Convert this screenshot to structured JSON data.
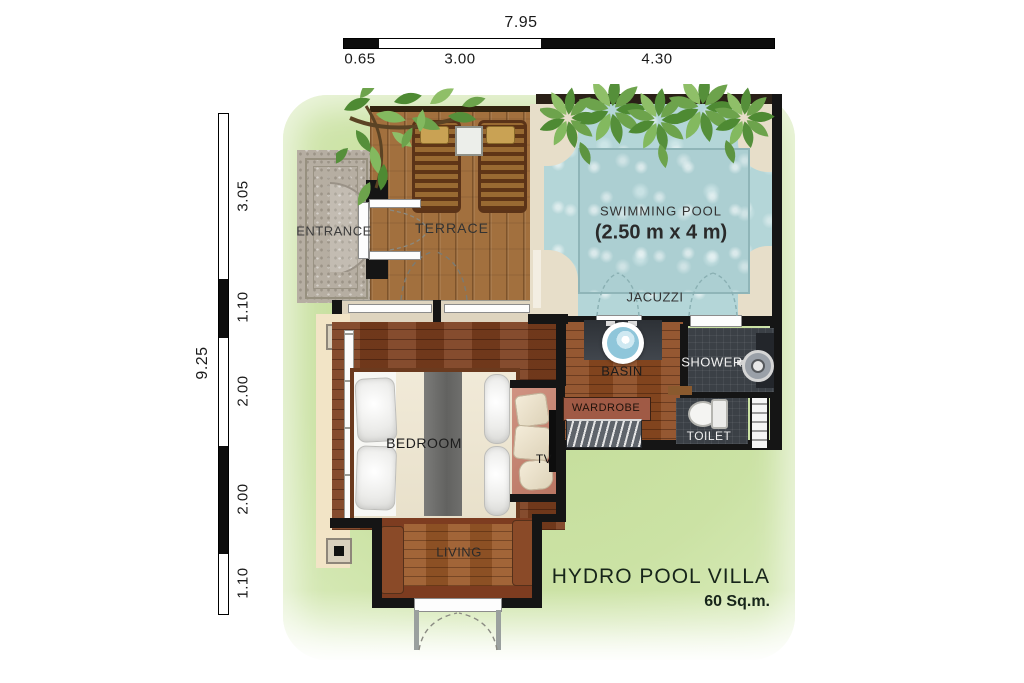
{
  "title": {
    "name": "HYDRO POOL VILLA",
    "area": "60 Sq.m."
  },
  "dimensions": {
    "top": {
      "total": "7.95",
      "segments": [
        {
          "label": "0.65"
        },
        {
          "label": "3.00"
        },
        {
          "label": "4.30"
        }
      ]
    },
    "left": {
      "total": "9.25",
      "segments": [
        {
          "label": "3.05"
        },
        {
          "label": "1.10"
        },
        {
          "label": "2.00"
        },
        {
          "label": "2.00"
        },
        {
          "label": "1.10"
        }
      ]
    }
  },
  "rooms": {
    "entrance": {
      "label": "ENTRANCE"
    },
    "terrace": {
      "label": "TERRACE"
    },
    "pool": {
      "label": "SWIMMING POOL",
      "size": "(2.50 m x 4 m)"
    },
    "jacuzzi": {
      "label": "JACUZZI"
    },
    "basin": {
      "label": "BASIN"
    },
    "shower": {
      "label": "SHOWER"
    },
    "wardrobe": {
      "label": "WARDROBE"
    },
    "toilet": {
      "label": "TOILET"
    },
    "bedroom": {
      "label": "BEDROOM"
    },
    "tv": {
      "label": "TV"
    },
    "living": {
      "label": "LIVING"
    }
  },
  "icons": {
    "foliage": "foliage-icon",
    "basin": "basin-icon",
    "shower_head": "shower-head-icon",
    "toilet_fixture": "toilet-icon",
    "towel_ladder": "towel-ladder-icon",
    "hanger_rail": "hanger-rail-icon",
    "door_swing": "door-swing-icon"
  },
  "colors": {
    "lawn_green": "#cbe2a4",
    "pool_water": "#b4d6d8",
    "terrace_wood": "#a2703e",
    "floor_wood": "#7c3e1e",
    "dark_tile": "#3b4046",
    "wall_black": "#151515",
    "title_text": "#17251a"
  }
}
